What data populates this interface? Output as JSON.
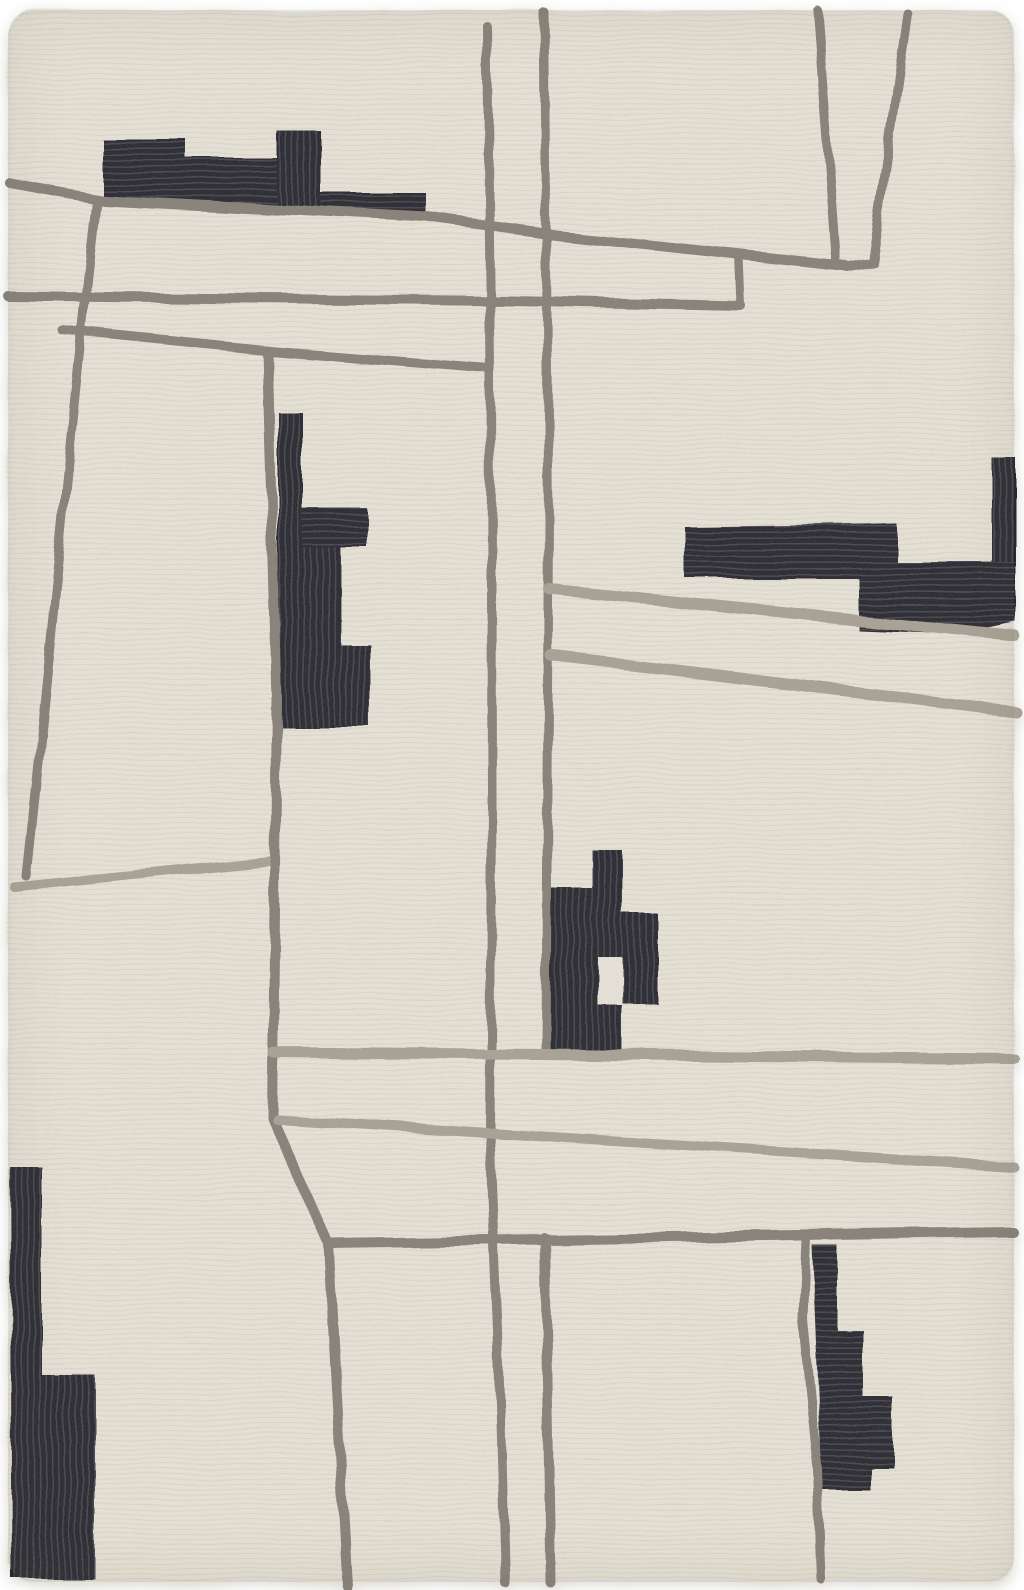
{
  "figure": {
    "kind": "product-photo",
    "subject": "hand-tufted wool area rug, abstract geometric pattern",
    "style": "cream ground, warm gray tufted lines, charcoal block shapes"
  },
  "palette": {
    "photo_bg": "#ffffff",
    "rug_base": "#e8e4d9",
    "rug_rib": "#d5cfc1",
    "line_dark": "#868078",
    "line_light": "#a8a295",
    "black_fill": "#25252d",
    "black_rib": "#45454f",
    "edge_shadow": "#c9c5bc"
  },
  "rug": {
    "x": 8,
    "y": 10,
    "width": 1006,
    "height": 1572,
    "radius": 24
  },
  "art": {
    "lines": [
      {
        "name": "line-top-diagonal",
        "color": "line_dark",
        "width": 10,
        "d": "M10,183 L103,200 L427,217 L556,235 L846,266"
      },
      {
        "name": "line-left-branch",
        "color": "line_dark",
        "width": 9,
        "d": "M96,201 C80,330 58,580 26,876"
      },
      {
        "name": "line-left-horizontal",
        "color": "line_light",
        "width": 9,
        "d": "M14,887 L270,861"
      },
      {
        "name": "line-upper-horizontal",
        "color": "line_dark",
        "width": 10,
        "d": "M8,296 L512,301 L741,306"
      },
      {
        "name": "line-upper-connector",
        "color": "line_dark",
        "width": 8,
        "d": "M739,255 L741,306"
      },
      {
        "name": "line-mid-diagonal",
        "color": "line_dark",
        "width": 9,
        "d": "M62,330 L270,351 L489,369"
      },
      {
        "name": "line-vertical-1",
        "color": "line_dark",
        "width": 9,
        "d": "M487,26 L491,370 L492,800 L490,1135 L498,1330 L505,1583"
      },
      {
        "name": "line-vertical-2-upper",
        "color": "line_dark",
        "width": 9,
        "d": "M544,12 L549,520 L546,1051"
      },
      {
        "name": "line-vertical-2-lower",
        "color": "line_dark",
        "width": 10,
        "d": "M545,1238 L551,1583"
      },
      {
        "name": "line-vertical-3",
        "color": "line_dark",
        "width": 10,
        "d": "M267,351 L277,700 L272,1117 L328,1243 L347,1586"
      },
      {
        "name": "line-vee-left",
        "color": "line_dark",
        "width": 9,
        "d": "M817,10 L830,180 L836,263"
      },
      {
        "name": "line-vee-right",
        "color": "line_dark",
        "width": 9,
        "d": "M907,13 L872,262 L847,267"
      },
      {
        "name": "line-right-diagonal-1",
        "color": "line_light",
        "width": 11,
        "d": "M549,589 L1015,636"
      },
      {
        "name": "line-right-diagonal-2",
        "color": "line_light",
        "width": 11,
        "d": "M551,656 L1015,711"
      },
      {
        "name": "line-lower-horizontal",
        "color": "line_light",
        "width": 11,
        "d": "M273,1052 L1014,1059"
      },
      {
        "name": "line-lower-diagonal",
        "color": "line_light",
        "width": 10,
        "d": "M277,1119 L1013,1166"
      },
      {
        "name": "line-bottom-horizontal",
        "color": "line_dark",
        "width": 10,
        "d": "M329,1243 L1013,1232"
      },
      {
        "name": "line-vertical-4",
        "color": "line_dark",
        "width": 9,
        "d": "M806,1237 L803,1320 L818,1470 L822,1580"
      }
    ],
    "shapes": [
      {
        "name": "block-top-left",
        "rib": "h",
        "d": "M102,139 L186,139 L186,158 L277,158 L277,131 L321,131 L321,193 L426,193 L426,216 L321,209 L277,206 L102,195 Z"
      },
      {
        "name": "block-mid-left",
        "rib": "v",
        "d": "M278,412 L302,412 L302,508 L367,508 L367,547 L340,547 L340,644 L370,644 L370,727 L278,727 Z"
      },
      {
        "name": "block-right",
        "rib": "h",
        "d": "M685,527 L897,524 L897,562 L992,562 L992,458 L1016,458 L1016,622 L960,634 L858,630 L858,578 L685,578 Z"
      },
      {
        "name": "block-center",
        "rib": "v",
        "d": "M592,850 L622,850 L622,913 L657,913 L657,1003 L622,1003 L622,1050 L545,1050 L545,888 L592,888 Z"
      },
      {
        "name": "block-bottom-left",
        "rib": "v",
        "d": "M10,1167 L42,1167 L42,1375 L95,1375 L95,1579 L12,1579 Z"
      },
      {
        "name": "block-bottom-right",
        "rib": "h",
        "d": "M812,1245 L837,1245 L837,1330 L863,1330 L863,1397 L893,1397 L893,1467 L870,1467 L870,1490 L822,1490 Z"
      }
    ],
    "overlays": [
      {
        "name": "block-top-left-tower-rib",
        "fill": "ribv",
        "x": 277,
        "y": 131,
        "w": 44,
        "h": 75
      },
      {
        "name": "block-right-tower-rib",
        "fill": "ribv",
        "x": 992,
        "y": 458,
        "w": 24,
        "h": 104
      },
      {
        "name": "block-mid-left-arm-rib",
        "fill": "ribh",
        "x": 302,
        "y": 508,
        "w": 65,
        "h": 39
      },
      {
        "name": "block-center-notch",
        "fill": "base",
        "x": 598,
        "y": 957,
        "w": 24,
        "h": 48
      }
    ]
  }
}
